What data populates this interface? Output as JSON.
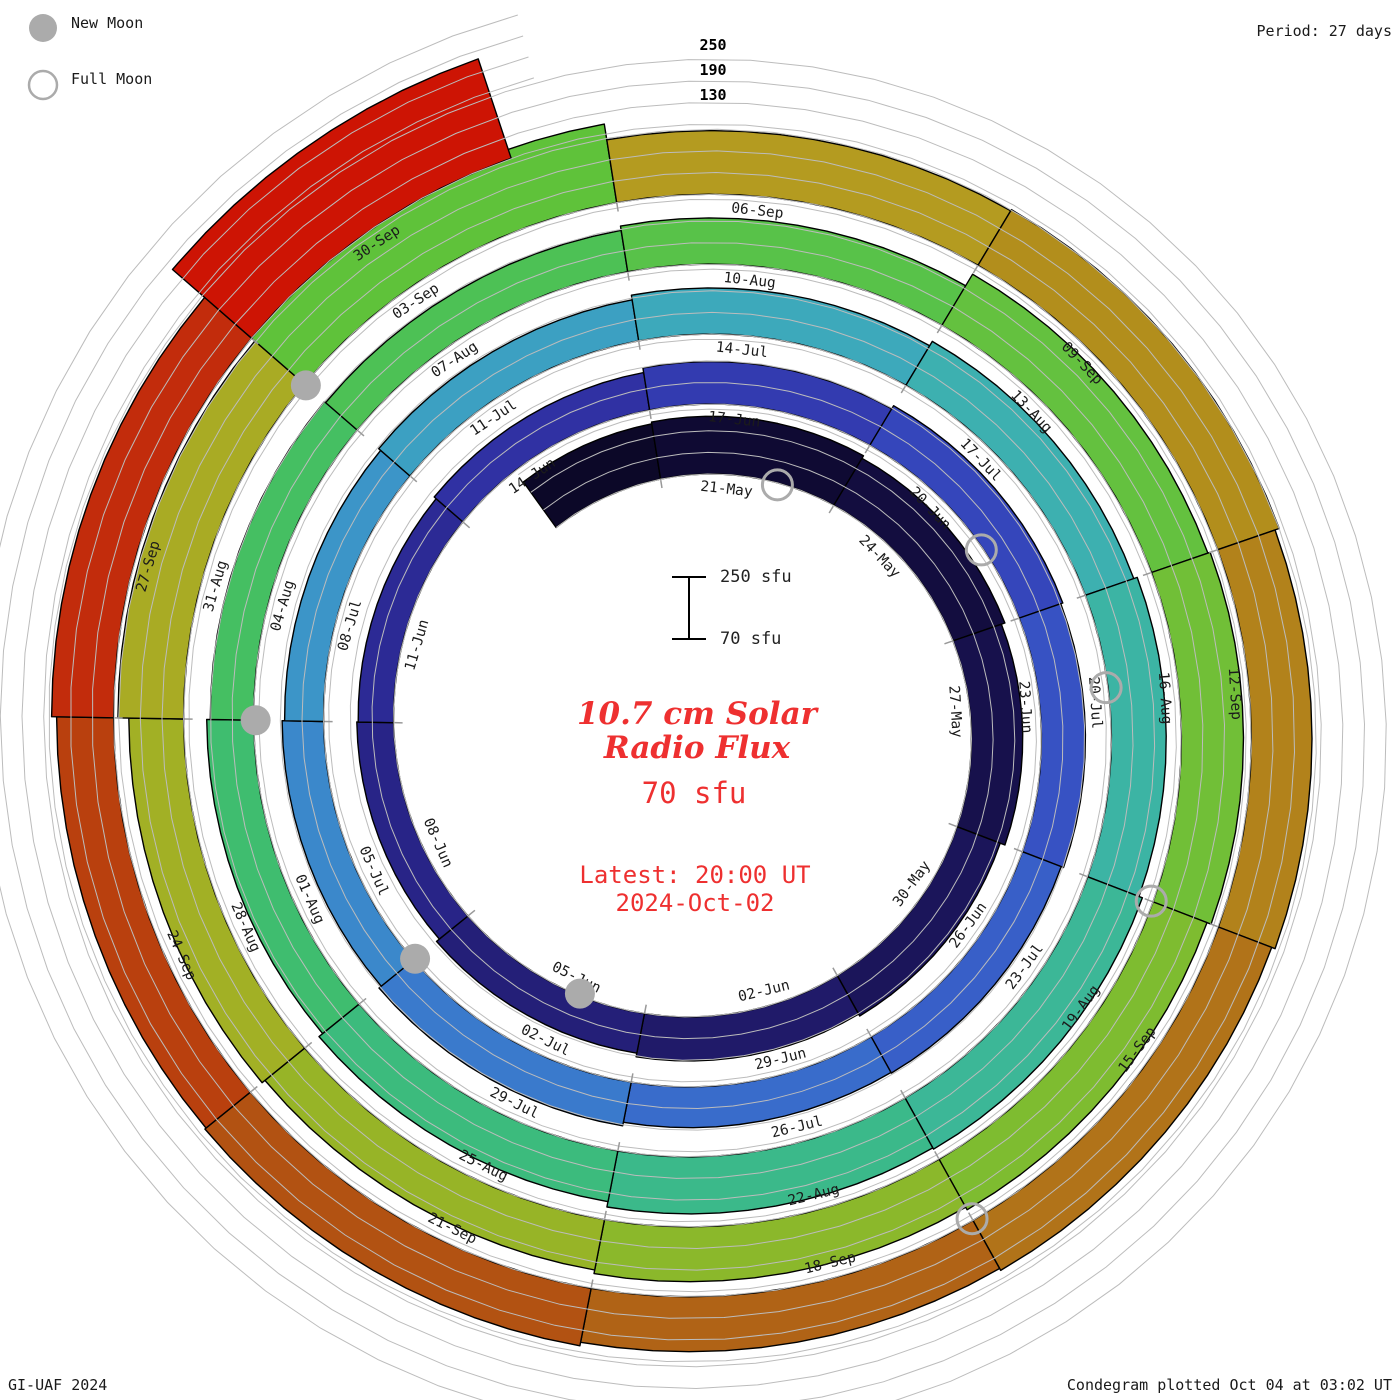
{
  "legend": {
    "new_moon": "New Moon",
    "full_moon": "Full Moon"
  },
  "header": {
    "period": "Period: 27 days",
    "scale_labels": [
      "250",
      "190",
      "130"
    ]
  },
  "center": {
    "scalebar_top": "250 sfu",
    "scalebar_bottom": "70 sfu",
    "title_line1": "10.7 cm Solar",
    "title_line2": "Radio Flux",
    "current_value": "70 sfu",
    "latest_line1": "Latest: 20:00 UT",
    "latest_line2": "2024-Oct-02",
    "accent_color": "#ee3030"
  },
  "footer": {
    "left": "GI-UAF 2024",
    "right": "Condegram plotted Oct 04 at 03:02 UT"
  },
  "chart_data": {
    "type": "spiral-bar-condegram",
    "title": "10.7 cm Solar Radio Flux",
    "units": "sfu",
    "period_days": 27,
    "flux_baseline": 70,
    "flux_gridlines": [
      130,
      190,
      250
    ],
    "segment_days": 3,
    "moon_marker_colors": {
      "fill": "#ababab",
      "stroke": "#ababab"
    },
    "gridline_color": "#bcbcbc",
    "label_color": "#1b1b1b",
    "segments": [
      {
        "label": "",
        "flux": 225,
        "color": "#0c0828"
      },
      {
        "label": "21-May",
        "flux": 230,
        "color": "#0f0a33"
      },
      {
        "label": "24-May",
        "flux": 222,
        "color": "#130d3f"
      },
      {
        "label": "27-May",
        "flux": 212,
        "color": "#17114c"
      },
      {
        "label": "30-May",
        "flux": 198,
        "color": "#1b155a"
      },
      {
        "label": "02-Jun",
        "flux": 192,
        "color": "#201a69"
      },
      {
        "label": "05-Jun",
        "flux": 182,
        "color": "#241f78"
      },
      {
        "label": "08-Jun",
        "flux": 172,
        "color": "#282487"
      },
      {
        "label": "11-Jun",
        "flux": 168,
        "color": "#2c2a95"
      },
      {
        "label": "14-Jun",
        "flux": 175,
        "color": "#3031a3"
      },
      {
        "label": "17-Jun",
        "flux": 188,
        "color": "#333bb0"
      },
      {
        "label": "20-Jun",
        "flux": 198,
        "color": "#3546bb"
      },
      {
        "label": "23-Jun",
        "flux": 192,
        "color": "#3752c3"
      },
      {
        "label": "26-Jun",
        "flux": 185,
        "color": "#385fc8"
      },
      {
        "label": "29-Jun",
        "flux": 183,
        "color": "#396ccb"
      },
      {
        "label": "02-Jul",
        "flux": 193,
        "color": "#3a7acc"
      },
      {
        "label": "05-Jul",
        "flux": 185,
        "color": "#3b88cb"
      },
      {
        "label": "08-Jul",
        "flux": 178,
        "color": "#3c95c8"
      },
      {
        "label": "11-Jul",
        "flux": 185,
        "color": "#3ca0c2"
      },
      {
        "label": "14-Jul",
        "flux": 198,
        "color": "#3da9bb"
      },
      {
        "label": "17-Jul",
        "flux": 212,
        "color": "#3db0b0"
      },
      {
        "label": "20-Jul",
        "flux": 222,
        "color": "#3cb4a4"
      },
      {
        "label": "23-Jul",
        "flux": 232,
        "color": "#3cb797"
      },
      {
        "label": "26-Jul",
        "flux": 228,
        "color": "#3bb98a"
      },
      {
        "label": "29-Jul",
        "flux": 213,
        "color": "#3cbb7d"
      },
      {
        "label": "01-Aug",
        "flux": 200,
        "color": "#3fbd6f"
      },
      {
        "label": "04-Aug",
        "flux": 190,
        "color": "#45bf62"
      },
      {
        "label": "07-Aug",
        "flux": 186,
        "color": "#4dc155"
      },
      {
        "label": "10-Aug",
        "flux": 198,
        "color": "#58c249"
      },
      {
        "label": "13-Aug",
        "flux": 235,
        "color": "#64c13f"
      },
      {
        "label": "16-Aug",
        "flux": 242,
        "color": "#71bf37"
      },
      {
        "label": "19-Aug",
        "flux": 230,
        "color": "#7ebc30"
      },
      {
        "label": "22-Aug",
        "flux": 222,
        "color": "#8bb82b"
      },
      {
        "label": "25-Aug",
        "flux": 212,
        "color": "#97b427"
      },
      {
        "label": "28-Aug",
        "flux": 222,
        "color": "#a2b025"
      },
      {
        "label": "31-Aug",
        "flux": 252,
        "color": "#a9ab24"
      },
      {
        "label": "03-Sep",
        "flux": 290,
        "color": "#5fc23a"
      },
      {
        "label": "06-Sep",
        "flux": 246,
        "color": "#b49b20"
      },
      {
        "label": "09-Sep",
        "flux": 250,
        "color": "#b28e1c"
      },
      {
        "label": "12-Sep",
        "flux": 238,
        "color": "#b2821b"
      },
      {
        "label": "15-Sep",
        "flux": 228,
        "color": "#b17319"
      },
      {
        "label": "18-Sep",
        "flux": 222,
        "color": "#b06316"
      },
      {
        "label": "21-Sep",
        "flux": 232,
        "color": "#b25212"
      },
      {
        "label": "24-Sep",
        "flux": 228,
        "color": "#b9400e"
      },
      {
        "label": "27-Sep",
        "flux": 242,
        "color": "#c22c0c"
      },
      {
        "label": "30-Sep",
        "flux": 360,
        "color": "#cd1404"
      }
    ],
    "moons": [
      {
        "date": "23-May",
        "phase": "full",
        "day": 4
      },
      {
        "date": "06-Jun",
        "phase": "new",
        "day": 18
      },
      {
        "date": "22-Jun",
        "phase": "full",
        "day": 34
      },
      {
        "date": "05-Jul",
        "phase": "new",
        "day": 47
      },
      {
        "date": "21-Jul",
        "phase": "full",
        "day": 63
      },
      {
        "date": "04-Aug",
        "phase": "new",
        "day": 77
      },
      {
        "date": "19-Aug",
        "phase": "full",
        "day": 92
      },
      {
        "date": "03-Sep",
        "phase": "new",
        "day": 107
      },
      {
        "date": "18-Sep",
        "phase": "full",
        "day": 122
      }
    ]
  }
}
